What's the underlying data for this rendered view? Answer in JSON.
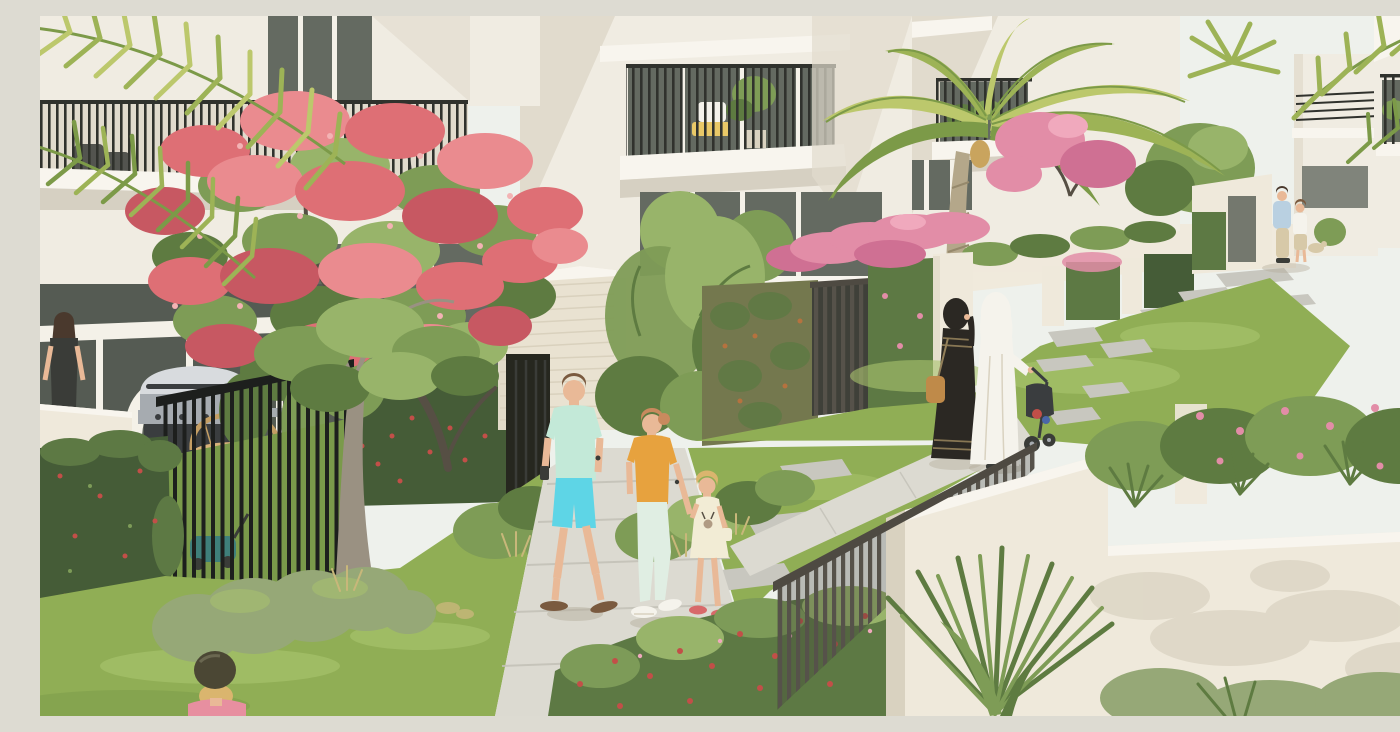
{
  "scene": {
    "title": "Townhouse community garden walk",
    "type": "architectural-render",
    "description": "Sun-lit rendering of a modern townhouse community: white angular villas with dark-railed balconies overlook landscaped garden paths where a family strolls, two women in traditional abayas push a stroller, a couple chats in the distance, and lush planting - a red-flowering flame tree, date palms, bougainvillea-topped hedge walls, stepping-stone lawns - fills the courtyard. A resident stands at a barbecue terrace behind a black picket fence and a little girl in a bike helmet rides past in the foreground.",
    "objects": [
      "modern white townhouse facades with balconies",
      "royal poinciana (flame tree) in red bloom",
      "date palm with full crown",
      "overhanging palm fronds (top corners)",
      "family walking on concrete garden path (man, woman, child)",
      "woman in black abaya on phone with tan shoulder bag",
      "woman in white abaya pushing a dark stroller",
      "distant couple chatting on stepping-stone path",
      "girl in olive bike helmet and pink top",
      "resident at terrace with stainless barbecue grill and wicker chair",
      "black and bronze metal picket fences and gates",
      "travertine gate pillar",
      "ivy-covered garden walls with red and pink flowers",
      "bougainvillea hedges and pink blossom trees",
      "lawns with square stepping stones",
      "teal lawn mower in fenced yard"
    ]
  },
  "palette": {
    "sky": "#eef1ec",
    "building": "#f0ece2",
    "building_shade": "#e1dbcd",
    "building_bright": "#f8f5ee",
    "window_glass": "#646a61",
    "window_mullion": "#f4f1e8",
    "terrace_glass": "#555b53",
    "railing_dark": "#30322d",
    "fence_black": "#1d1f1d",
    "gate_black": "#26271f",
    "gate_bronze": "#56524a",
    "rail_top": "#4e4a42",
    "gate_shadow": "#3f4039",
    "slab_shadow": "#d6d0c2",
    "travertine": "#e9e2d1",
    "travertine_line": "#cfc6b1",
    "cream_wall": "#efe9db",
    "cream_shadow": "#d9d2c0",
    "palm_light": "#bcc86c",
    "palm_mid": "#9db356",
    "palm_dark": "#7c9a48",
    "palm_trunk": "#b4a78a",
    "palm_trunk_line": "#96896c",
    "flame_red": "#de6f75",
    "flame_red_light": "#ea8b8f",
    "flame_red_deep": "#c75862",
    "flame_speck": "#f3b3b4",
    "branch_dark": "#564f44",
    "trunk_light": "#9a9182",
    "leaf_green": "#7e9c56",
    "leaf_light": "#98b46a",
    "leaf_dark": "#5e7b41",
    "grass": "#90ae55",
    "grass_light": "#aac46e",
    "grass_shade": "#7a9a4a",
    "bush_gray": "#96a877",
    "dry_grass": "#c8b77a",
    "path": "#dcdad1",
    "path_line": "#c3c1b7",
    "stone": "#c8c7bf",
    "hedge": "#5d7944",
    "hedge_dark": "#455c37",
    "hedge_light": "#7d9b58",
    "vine_brown": "#74784e",
    "vine_rust": "#b5723f",
    "bougainvillea": "#e28da7",
    "bougainvillea_deep": "#cf7093",
    "pink_speck": "#f0a9bd",
    "red_flower": "#c24f48",
    "steel": "#a6abb0",
    "steel_light": "#d8dbde",
    "grill_dark": "#3a3d3f",
    "skin": "#e9b997",
    "hair_brown": "#7a5a3f",
    "hair_dark": "#4a392d",
    "hair_blonde": "#dab56e",
    "hair_red": "#c98a5e",
    "shirt_mint": "#c3e9d8",
    "shorts_cyan": "#5ed5e6",
    "shirt_orange": "#e7a23e",
    "pants_mint": "#e0eee3",
    "white_cloth": "#f5f3ec",
    "cloth_shade": "#dcd7c9",
    "dress_cream": "#f2ecd5",
    "abaya_black": "#2b2823",
    "abaya_trim": "#93805a",
    "bag_tan": "#bf8a49",
    "helmet_olive": "#4b4734",
    "top_pink": "#e78fa0",
    "shoe_red": "#d8696a",
    "wicker": "#c49e64",
    "wicker_fill": "#d8b27a",
    "mower_teal": "#3f7f7a",
    "ground_shadow": "#b2ab98",
    "couple_blue": "#b9d0e1",
    "khaki": "#d7c9a8",
    "detail_dark": "#3a3c38",
    "chair_yellow": "#e9c968",
    "dates": "#c9a45e"
  }
}
